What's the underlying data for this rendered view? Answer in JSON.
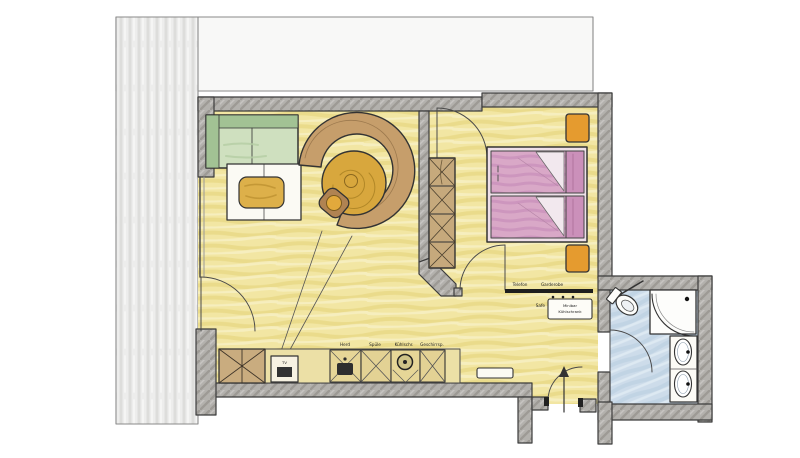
{
  "labels": {
    "kitchen": [
      "Herd",
      "Spüle",
      "Kühlschr.",
      "Geschirrsp."
    ],
    "tv": "TV",
    "hall": {
      "telefon": "Telefon",
      "garderobe": "Garderobe",
      "safe": "Safe",
      "minibar_line1": "Minibar",
      "minibar_line2": "Kühlschrank"
    }
  },
  "palette": {
    "wall_gray": "#b3b1ad",
    "wall_stroke": "#3c3c3c",
    "floor_yellow": "#f2e6a3",
    "bath_floor_blue": "#cddcea",
    "terrace_gray": "#ececea",
    "sofa_green": "#a2c294",
    "sofa_seat_green": "#cfe0bf",
    "ring_sofa_tan": "#c69e6b",
    "round_table_gold": "#d8a73d",
    "bed_pink": "#d9a8c7",
    "pillow_pink": "#cb90ba",
    "nightstand_orange": "#e59b2f",
    "kitchen_counter": "#ece0a6",
    "ink": "#333333"
  }
}
